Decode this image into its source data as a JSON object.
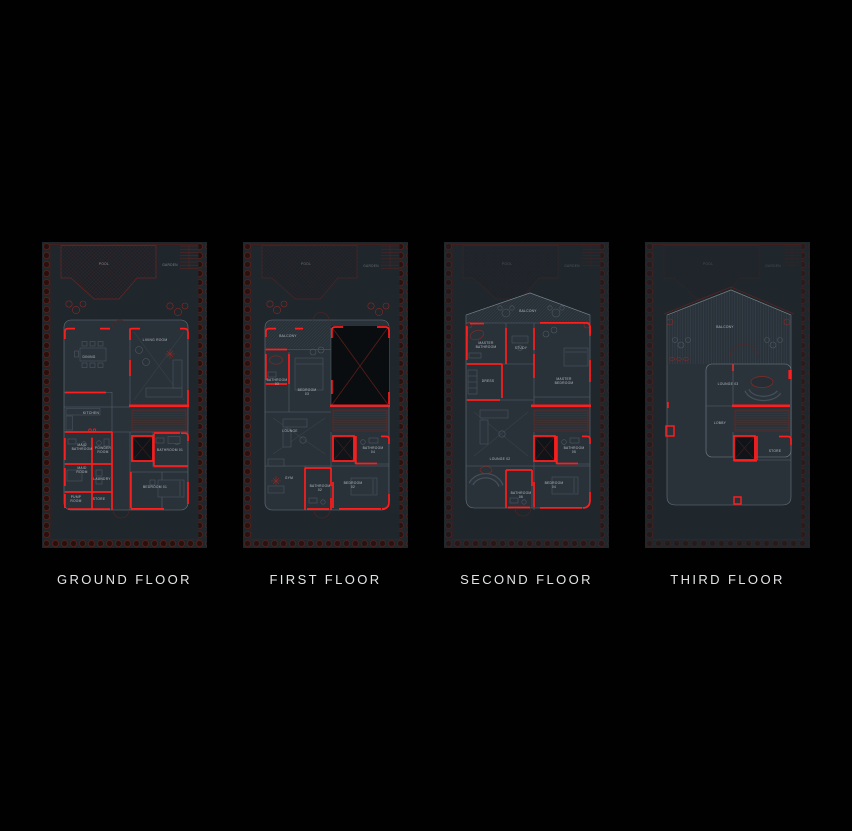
{
  "palette": {
    "background": "#010101",
    "wall_red": "#ff1d1d",
    "dark_red": "#6e2522",
    "plan_fill": "#293139",
    "site_fill": "#1f262c",
    "label_text": "#e2e4e5"
  },
  "floors": [
    {
      "id": "ground-floor",
      "label": "GROUND FLOOR",
      "rooms": [
        {
          "name": "POOL",
          "x": 62,
          "y": 23,
          "o": 0.7
        },
        {
          "name": "GARDEN",
          "x": 128,
          "y": 24,
          "o": 0.6
        },
        {
          "name": "DINING",
          "x": 47,
          "y": 116
        },
        {
          "name": "LIVING ROOM",
          "x": 113,
          "y": 99
        },
        {
          "name": "KITCHEN",
          "x": 49,
          "y": 172
        },
        {
          "name": "MAID\nBATHROOM",
          "x": 40,
          "y": 204
        },
        {
          "name": "POWDER\nROOM",
          "x": 61,
          "y": 207
        },
        {
          "name": "MAID\nROOM",
          "x": 40,
          "y": 227
        },
        {
          "name": "LAUNDRY",
          "x": 60,
          "y": 238
        },
        {
          "name": "PUMP\nROOM",
          "x": 34,
          "y": 256
        },
        {
          "name": "STORE",
          "x": 57,
          "y": 258
        },
        {
          "name": "BATHROOM 01",
          "x": 128,
          "y": 209
        },
        {
          "name": "BEDROOM 01",
          "x": 113,
          "y": 246
        }
      ]
    },
    {
      "id": "first-floor",
      "label": "FIRST FLOOR",
      "rooms": [
        {
          "name": "POOL",
          "x": 63,
          "y": 23,
          "o": 0.5
        },
        {
          "name": "GARDEN",
          "x": 128,
          "y": 25,
          "o": 0.45
        },
        {
          "name": "BALCONY",
          "x": 45,
          "y": 95
        },
        {
          "name": "BATHROOM\n03",
          "x": 34,
          "y": 139
        },
        {
          "name": "BEDROOM\n03",
          "x": 64,
          "y": 149
        },
        {
          "name": "LOUNGE",
          "x": 47,
          "y": 190
        },
        {
          "name": "BATHROOM\n04",
          "x": 130,
          "y": 207
        },
        {
          "name": "GYM",
          "x": 46,
          "y": 237
        },
        {
          "name": "BATHROOM\n02",
          "x": 77,
          "y": 245
        },
        {
          "name": "BEDROOM\n02",
          "x": 110,
          "y": 242
        }
      ]
    },
    {
      "id": "second-floor",
      "label": "SECOND FLOOR",
      "rooms": [
        {
          "name": "POOL",
          "x": 63,
          "y": 23,
          "o": 0.3
        },
        {
          "name": "GARDEN",
          "x": 128,
          "y": 25,
          "o": 0.3
        },
        {
          "name": "BALCONY",
          "x": 84,
          "y": 70
        },
        {
          "name": "MASTER\nBATHROOM",
          "x": 42,
          "y": 102
        },
        {
          "name": "STUDY",
          "x": 77,
          "y": 107
        },
        {
          "name": "MASTER\nBEDROOM",
          "x": 120,
          "y": 138
        },
        {
          "name": "DRESS",
          "x": 44,
          "y": 140
        },
        {
          "name": "LOUNGE 02",
          "x": 56,
          "y": 218
        },
        {
          "name": "BATHROOM\n05",
          "x": 130,
          "y": 207
        },
        {
          "name": "BEDROOM\n04",
          "x": 110,
          "y": 242
        },
        {
          "name": "BATHROOM\n06",
          "x": 77,
          "y": 252
        }
      ]
    },
    {
      "id": "third-floor",
      "label": "THIRD FLOOR",
      "rooms": [
        {
          "name": "POOL",
          "x": 63,
          "y": 23,
          "o": 0.25
        },
        {
          "name": "GARDEN",
          "x": 128,
          "y": 25,
          "o": 0.25
        },
        {
          "name": "BALCONY",
          "x": 80,
          "y": 86
        },
        {
          "name": "LOUNGE 03",
          "x": 83,
          "y": 143
        },
        {
          "name": "LOBBY",
          "x": 75,
          "y": 182
        },
        {
          "name": "STORE",
          "x": 130,
          "y": 210
        }
      ]
    }
  ]
}
